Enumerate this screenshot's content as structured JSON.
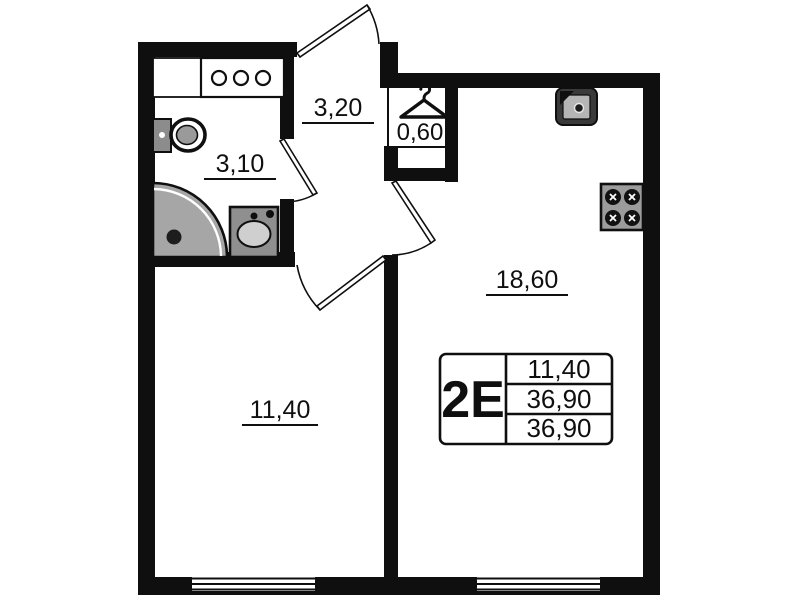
{
  "unit": {
    "table": {
      "type_label": "2E",
      "rows": [
        "11,40",
        "36,90",
        "36,90"
      ]
    }
  },
  "rooms": {
    "bathroom_area": "3,10",
    "hallway_area": "3,20",
    "wardrobe_area": "0,60",
    "kitchen_living_area": "18,60",
    "room_area": "11,40"
  },
  "icons": {
    "hanger": "wardrobe-hanger",
    "stove": "four-burner-stove",
    "kitchen_sink": "kitchen-sink",
    "shower": "corner-shower",
    "toilet": "toilet",
    "washbasin": "washbasin",
    "cabinet": "three-knob-cabinet",
    "counter": "counter"
  },
  "colors": {
    "wall": "#0f0f0f",
    "background": "#ffffff",
    "fixture_gray": "#a6a6a6"
  }
}
